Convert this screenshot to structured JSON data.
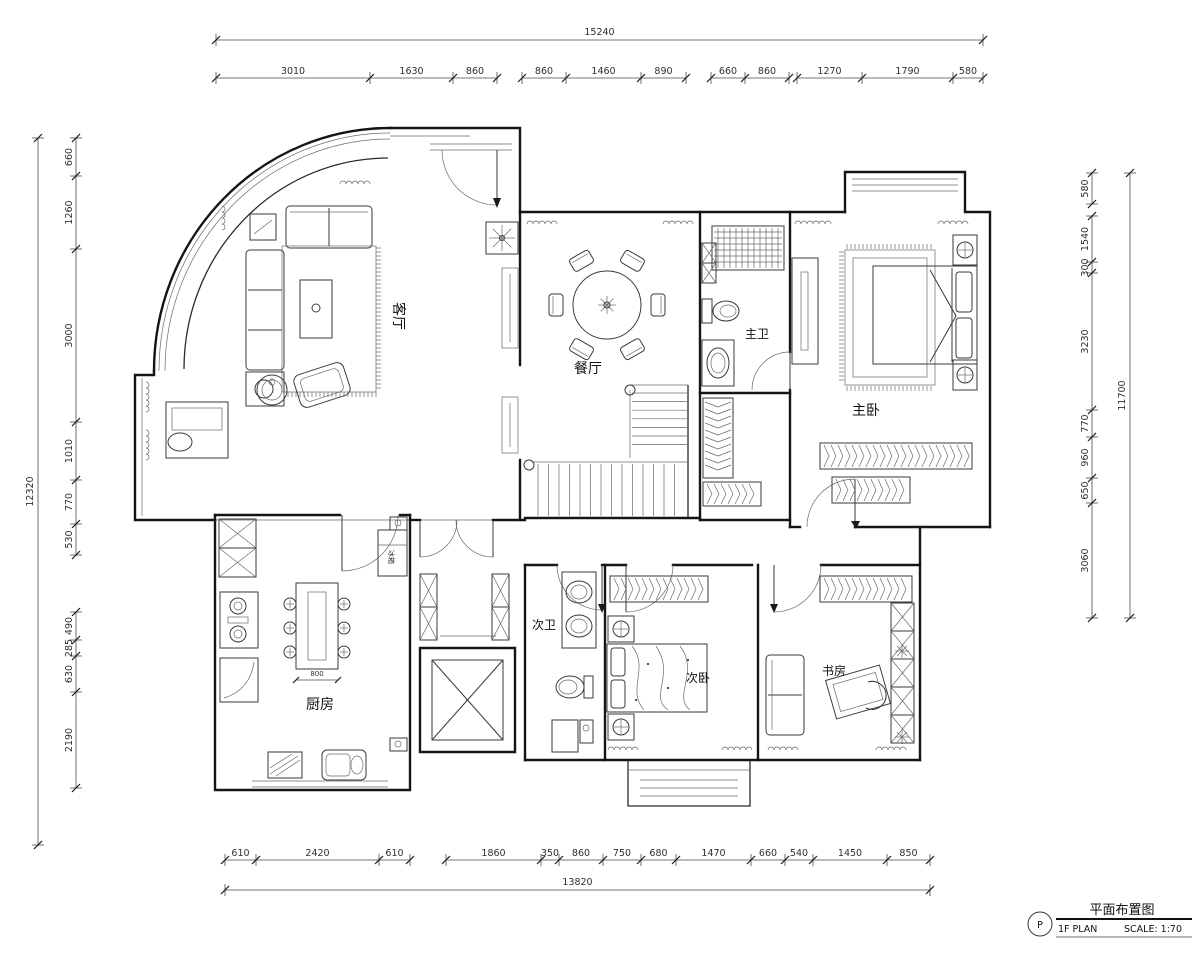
{
  "rooms": {
    "living": "客厅",
    "dining": "餐厅",
    "master_bath": "主卫",
    "master_bedroom": "主卧",
    "kitchen": "厨房",
    "second_bath": "次卫",
    "second_bedroom": "次卧",
    "study": "书房"
  },
  "labels": {
    "fridge": "冰箱"
  },
  "dims": {
    "top": {
      "overall": "15240",
      "segments": [
        "3010",
        "1630",
        "860",
        "860",
        "1460",
        "890",
        "660",
        "860",
        "1270",
        "1790",
        "580"
      ]
    },
    "bottom": {
      "overall": "13820",
      "segments": [
        "610",
        "2420",
        "610",
        "1860",
        "350",
        "860",
        "750",
        "680",
        "1470",
        "660",
        "540",
        "1450",
        "850"
      ]
    },
    "left": {
      "overall": "12320",
      "segments": [
        "660",
        "1260",
        "3000",
        "1010",
        "770",
        "530",
        "490",
        "285",
        "630",
        "2190"
      ]
    },
    "right": {
      "overall": "11700",
      "segments": [
        "580",
        "1540",
        "300",
        "3230",
        "770",
        "960",
        "650",
        "3060"
      ]
    },
    "kitchen_island": "800"
  },
  "title_block": {
    "badge": "P",
    "title": "平面布置图",
    "plan_name": "1F PLAN",
    "scale": "SCALE: 1:70"
  }
}
